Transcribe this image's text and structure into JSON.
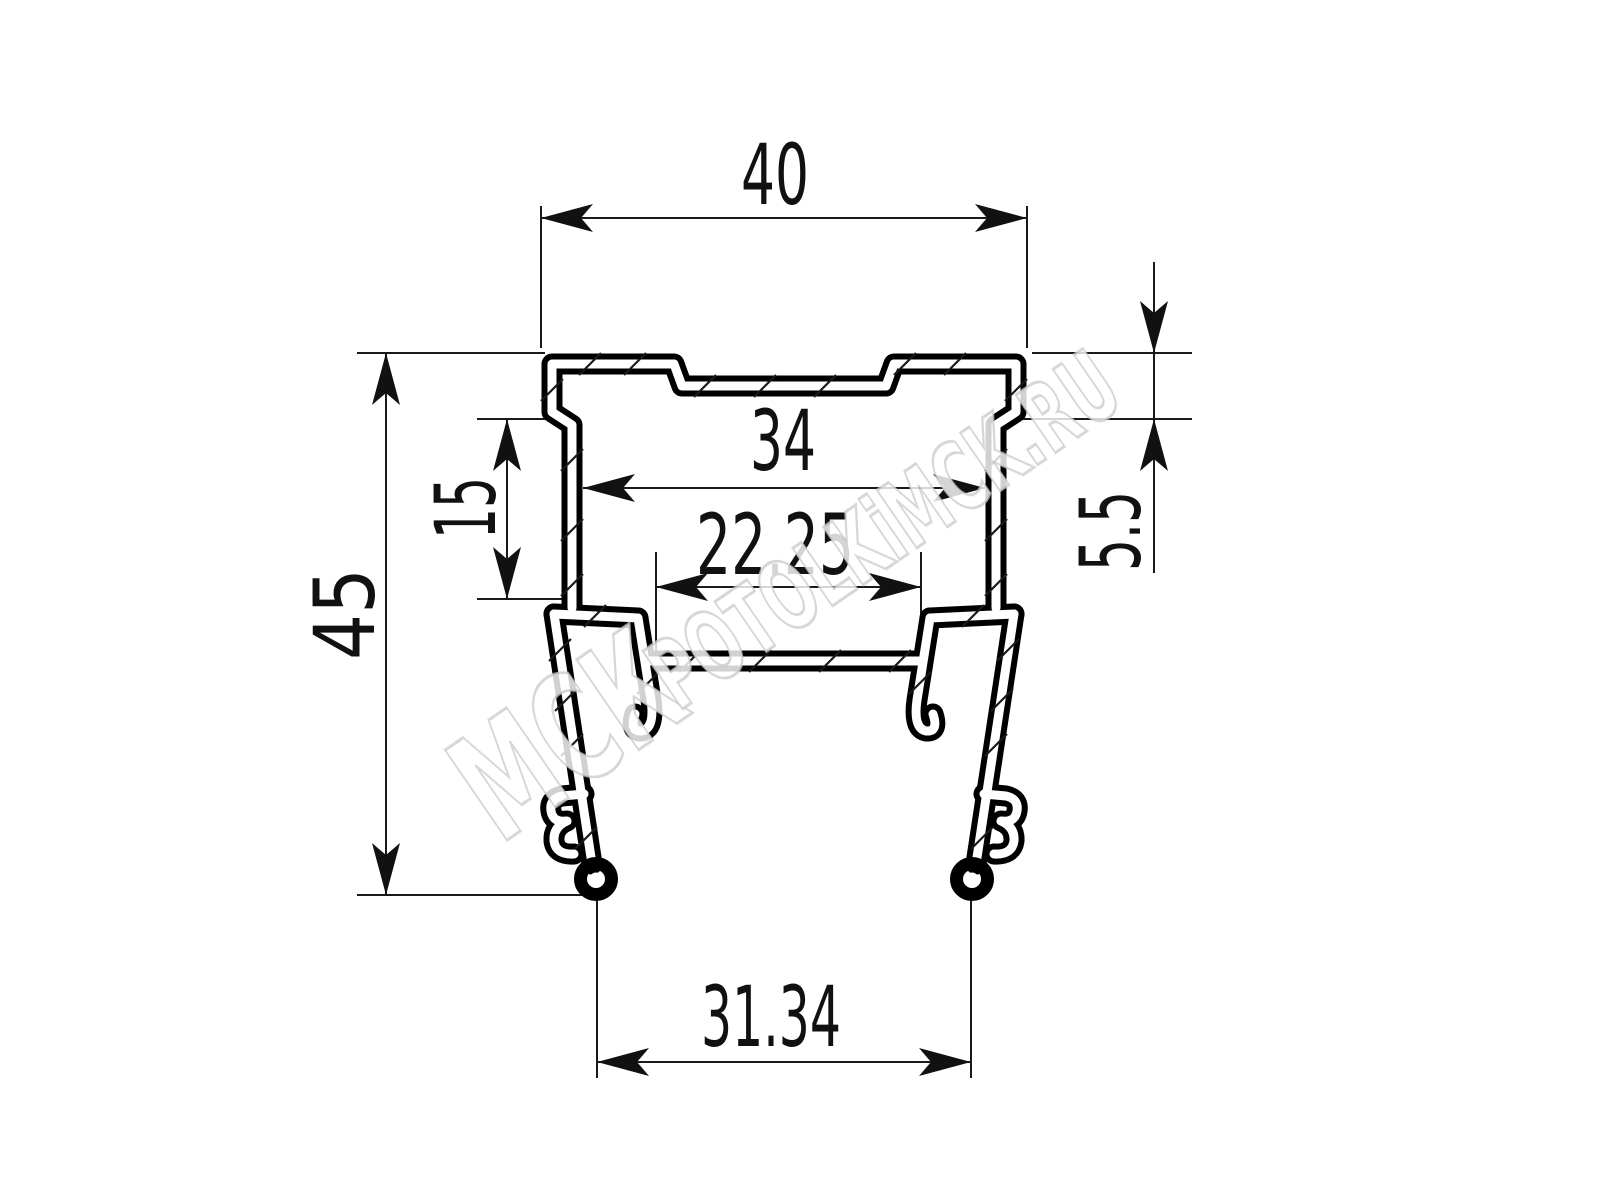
{
  "drawing": {
    "type": "technical-profile-cross-section",
    "units": "mm",
    "dimensions": {
      "top_width": "40",
      "inner_width": "34",
      "slot_width": "22.25",
      "side_wall_height": "15",
      "overall_height": "45",
      "lip_offset": "5.5",
      "leg_span": "31.34"
    },
    "watermark": {
      "brand": "МСК",
      "site": "POTOLKiMCK.RU"
    },
    "colors": {
      "ink": "#000000",
      "background": "#ffffff",
      "watermark_stroke": "#c9c9c9"
    }
  }
}
